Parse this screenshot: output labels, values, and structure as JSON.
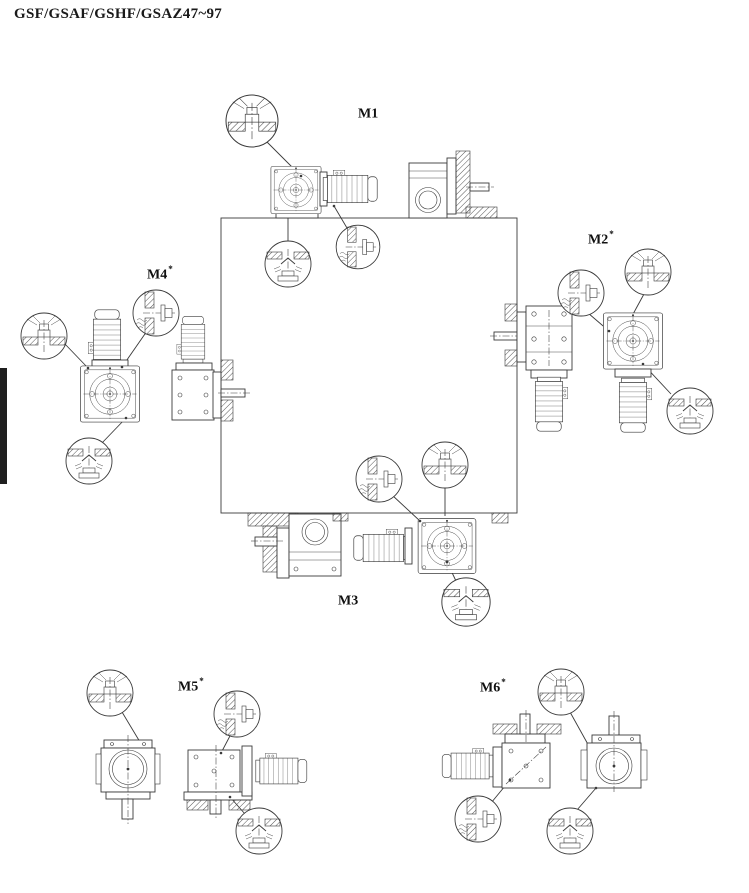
{
  "page": {
    "title": "GSF/GSAF/GSHF/GSAZ47~97",
    "background": "#ffffff",
    "line_color": "#3a3a3a",
    "edge_tab_color": "#1f1f1f"
  },
  "positions": [
    {
      "id": "m1",
      "label": "M1",
      "sup": ""
    },
    {
      "id": "m2",
      "label": "M2",
      "sup": "*"
    },
    {
      "id": "m3",
      "label": "M3",
      "sup": ""
    },
    {
      "id": "m4",
      "label": "M4",
      "sup": "*"
    },
    {
      "id": "m5",
      "label": "M5",
      "sup": "*"
    },
    {
      "id": "m6",
      "label": "M6",
      "sup": "*"
    }
  ],
  "callout_icons": {
    "vent": "breather-vent-plug-icon",
    "level": "oil-level-plug-icon",
    "drain": "oil-drain-plug-icon"
  }
}
